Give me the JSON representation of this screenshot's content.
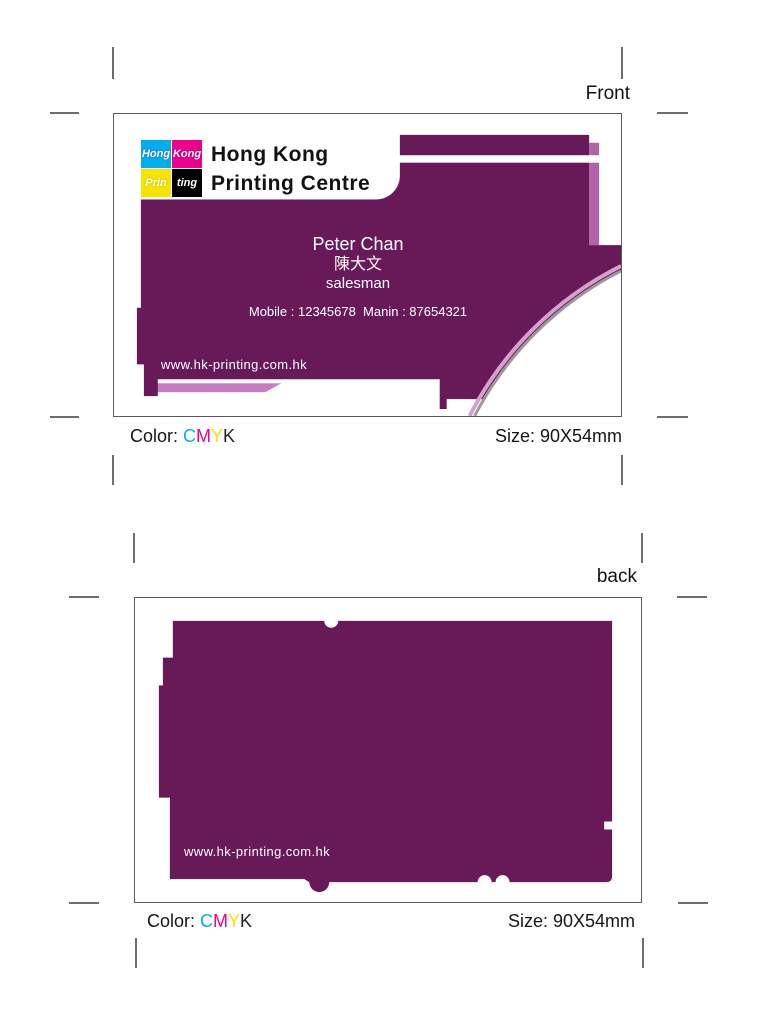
{
  "front": {
    "side_label": "Front",
    "card": {
      "logo_tiles": [
        "Hong",
        "Kong",
        "Prin",
        "ting"
      ],
      "company_line1": "Hong Kong",
      "company_line2": "Printing Centre",
      "person_name": "Peter Chan",
      "person_name_cjk": "陳大文",
      "person_title": "salesman",
      "phone_line": "Mobile : 12345678  Manin : 87654321",
      "website": "www.hk-printing.com.hk"
    },
    "color_label": "Color:",
    "cmyk_letters": [
      "C",
      "M",
      "Y",
      "K"
    ],
    "size_label": "Size: 90X54mm"
  },
  "back": {
    "side_label": "back",
    "card": {
      "website": "www.hk-printing.com.hk"
    },
    "color_label": "Color:",
    "cmyk_letters": [
      "C",
      "M",
      "Y",
      "K"
    ],
    "size_label": "Size: 90X54mm"
  },
  "colors": {
    "card_purple": "#681A58",
    "accent_mauve": "#B262A6",
    "accent_pink": "#CA7BC0",
    "arc_pink": "#D5A0CC",
    "arc_silver": "#9A9A9A",
    "logo_cyan": "#00AEEF",
    "logo_magenta": "#EC008C",
    "logo_yellow": "#F5E400",
    "logo_black": "#000000",
    "cmyk_text": [
      "#00AEEF",
      "#EC008C",
      "#F2E600",
      "#222222"
    ]
  }
}
